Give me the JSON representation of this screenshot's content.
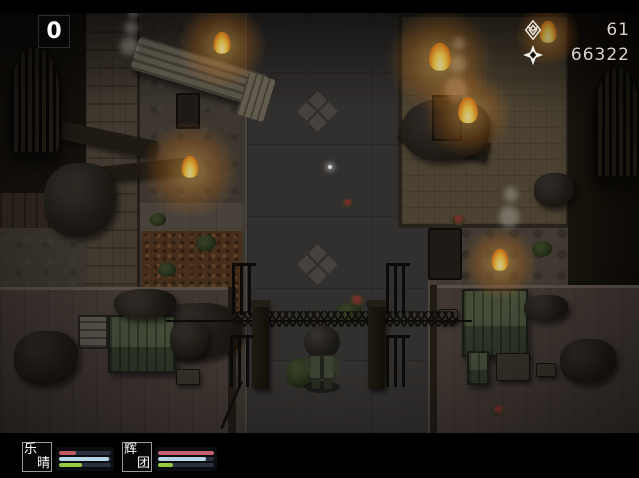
{
  "hud": {
    "counter": "0",
    "currencies": [
      {
        "icon": "emblem-icon",
        "value": "61"
      },
      {
        "icon": "four-point-star-icon",
        "value": "66322"
      }
    ],
    "party": [
      {
        "name": "乐晴",
        "chars": [
          "乐",
          "晴"
        ],
        "bars": [
          {
            "kind": "hp",
            "pct": 33,
            "style": "width:33%;background:#bf5a62"
          },
          {
            "kind": "mp",
            "pct": 97,
            "style": "width:97%;background:#b6d6e6"
          },
          {
            "kind": "tp",
            "pct": 45,
            "style": "width:45%;background:#96c840"
          }
        ]
      },
      {
        "name": "辉团",
        "chars": [
          "辉",
          "团"
        ],
        "bars": [
          {
            "kind": "hp",
            "pct": 100,
            "style": "width:100%;background:#c4606e"
          },
          {
            "kind": "mp",
            "pct": 86,
            "style": "width:86%;background:#b6d6e6"
          },
          {
            "kind": "tp",
            "pct": 27,
            "style": "width:27%;background:#96c840"
          }
        ]
      }
    ]
  },
  "colors": {
    "hp": "#bf5a62",
    "mp": "#b6d6e6",
    "tp": "#96c840",
    "fire": "#ffc04d",
    "hud_text": "#d8d4cc"
  }
}
